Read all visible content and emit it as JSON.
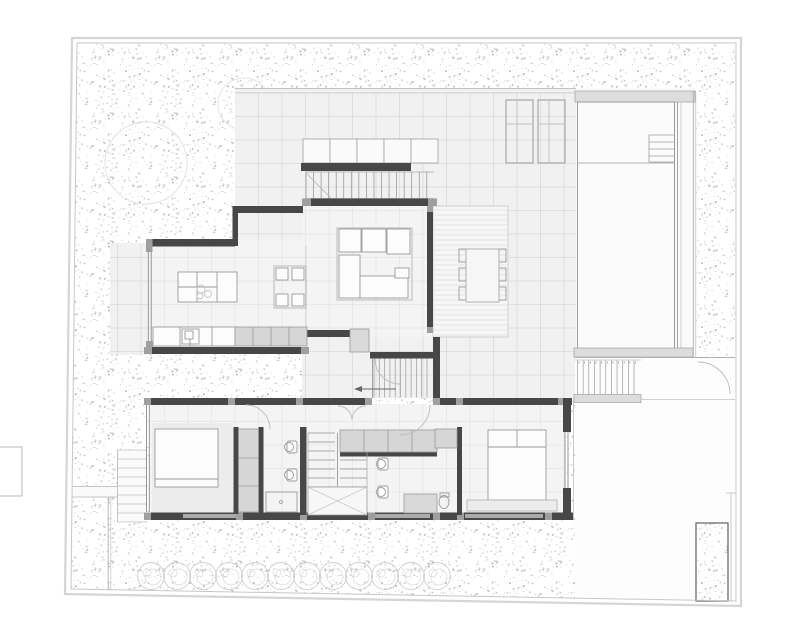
{
  "document": {
    "type": "architectural floor plan",
    "description": "single-family house ground floor and site plan with pool, terraces, garden and driveway",
    "visible_text": []
  },
  "colors": {
    "paper": "#ffffff",
    "boundary": "#c7c7c8",
    "stipple_a": "#aeb0b2",
    "stipple_b": "#bfc1c3",
    "stipple_c": "#cbcdce",
    "terrace_fill": "#f1f1f2",
    "terrace_grid": "#d8dadb",
    "interior_fill": "#f4f4f5",
    "interior_grid": "#e4e4e5",
    "wall_dark": "#474748",
    "wall_cap": "#9f9fa0",
    "glass": "#8a8a8b",
    "fixture_stroke": "#9a9a9b",
    "furniture_fill": "#fcfcfd",
    "cabinet_fill": "#d6d6d7",
    "pool_bar": "#dcdddd",
    "pool_fill": "#fbfbfc",
    "driveway_fill": "#fdfdfd",
    "deck_fill": "#f6f6f7",
    "deck_plank": "#dedede",
    "hedge": "#c6c8c9",
    "door_arc": "#bcbcbd",
    "tread": "#8f8f90"
  },
  "semantic_regions": [
    "garden",
    "paved-terrace",
    "swimming-pool",
    "pool-steps",
    "kitchen",
    "dining-area",
    "living-room",
    "timber-deck",
    "outdoor-dining",
    "entry-stair",
    "top-exterior-stair",
    "bedroom-1",
    "bedroom-2",
    "bathroom-1",
    "bathroom-2",
    "internal-stair",
    "driveway",
    "exterior-stair-to-driveway",
    "side-path",
    "hedge-row",
    "planter"
  ]
}
